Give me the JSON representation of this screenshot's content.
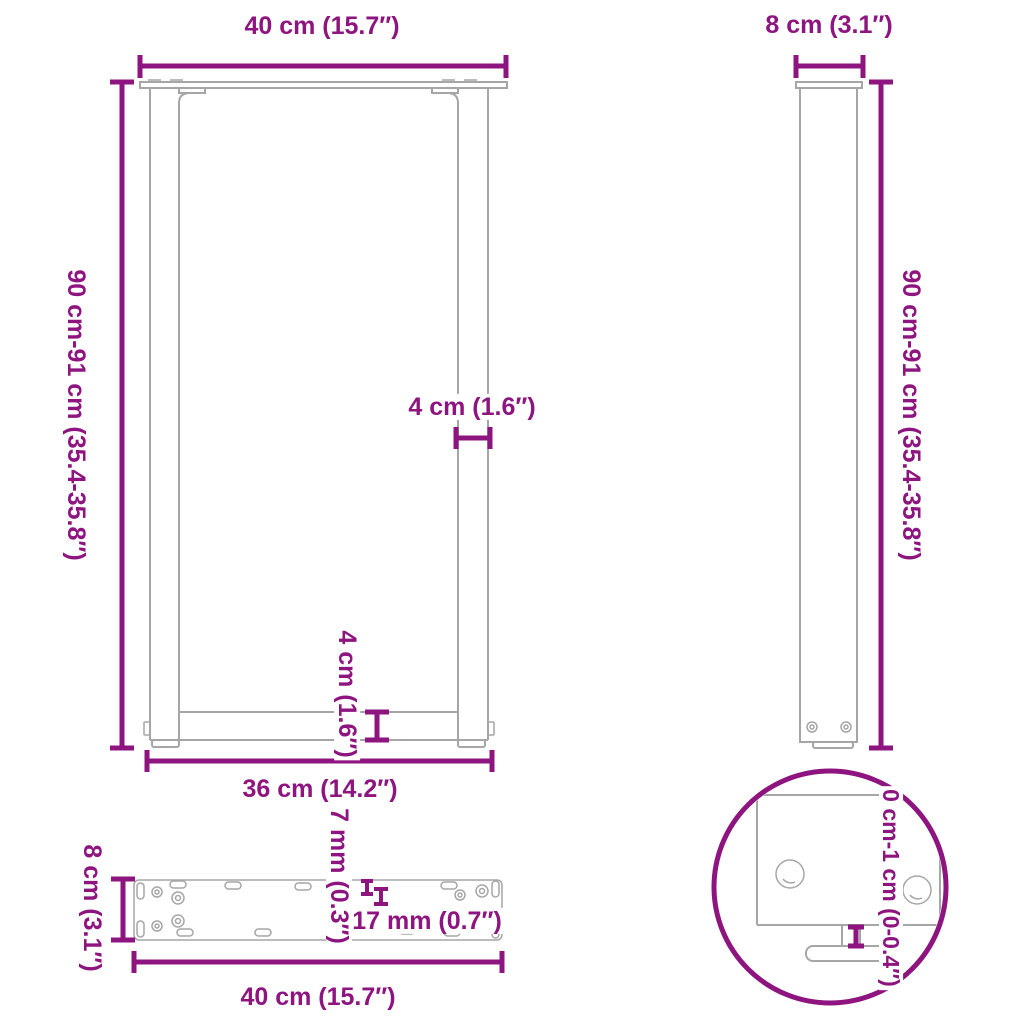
{
  "colors": {
    "dimension": "#8E1480",
    "drawing": "#A6A6A6"
  },
  "labels": {
    "front_width_top": "40 cm (15.7″)",
    "front_height": "90 cm-91 cm (35.4-35.8″)",
    "front_leg_thickness": "4 cm (1.6″)",
    "front_crossbar_height": "4 cm (1.6″)",
    "front_width_bottom": "36 cm (14.2″)",
    "side_width_top": "8 cm (3.1″)",
    "side_height": "90 cm-91 cm (35.4-35.8″)",
    "plate_depth": "8 cm (3.1″)",
    "plate_width": "40 cm (15.7″)",
    "plate_hole_diameter": "7 mm (0.3″)",
    "plate_slot_length": "17 mm (0.7″)",
    "detail_adjust_range": "0 cm-1 cm (0-0.4″)"
  }
}
